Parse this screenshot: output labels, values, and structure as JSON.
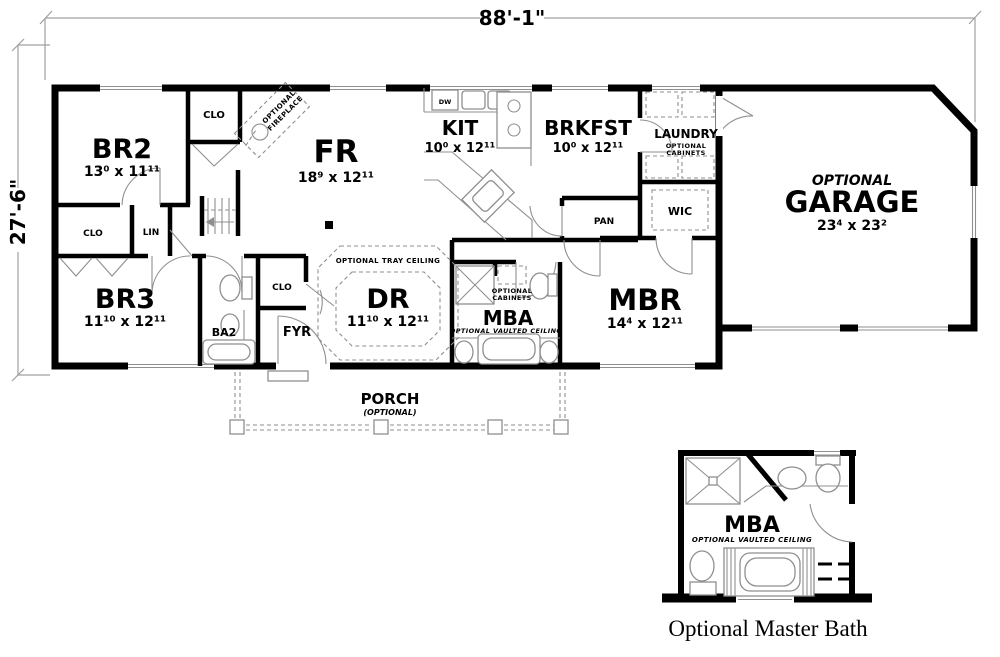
{
  "dimensions": {
    "width_label": "88'-1\"",
    "height_label": "27'-6\""
  },
  "rooms": {
    "br2": {
      "name": "BR2",
      "dims": "13⁰ x 11¹¹"
    },
    "br3": {
      "name": "BR3",
      "dims": "11¹⁰ x 12¹¹"
    },
    "fr": {
      "name": "FR",
      "dims": "18⁹ x 12¹¹"
    },
    "kit": {
      "name": "KIT",
      "dims": "10⁰ x 12¹¹"
    },
    "brkfst": {
      "name": "BRKFST",
      "dims": "10⁰ x 12¹¹"
    },
    "laundry": {
      "name": "LAUNDRY",
      "note_lines": [
        "OPTIONAL",
        "CABINETS"
      ]
    },
    "garage": {
      "prefix": "OPTIONAL",
      "name": "GARAGE",
      "dims": "23⁴ x 23²"
    },
    "dr": {
      "name": "DR",
      "dims": "11¹⁰ x 12¹¹",
      "note": "OPTIONAL TRAY CEILING"
    },
    "mba": {
      "name": "MBA",
      "note": "OPTIONAL VAULTED CEILING",
      "cabinets_lines": [
        "OPTIONAL",
        "CABINETS"
      ]
    },
    "mbr": {
      "name": "MBR",
      "dims": "14⁴ x 12¹¹"
    },
    "ba2": {
      "name": "BA2"
    },
    "fyr": {
      "name": "FYR"
    },
    "wic": {
      "name": "WIC"
    },
    "pan": {
      "name": "PAN"
    },
    "lin": {
      "name": "LIN"
    },
    "clo_br2": {
      "name": "CLO"
    },
    "clo_hall": {
      "name": "CLO"
    },
    "clo_fyr": {
      "name": "CLO"
    },
    "dw": {
      "name": "DW"
    },
    "porch": {
      "name": "PORCH",
      "note": "(OPTIONAL)"
    },
    "fireplace": {
      "note_lines": [
        "OPTIONAL",
        "FIREPLACE"
      ]
    }
  },
  "detail": {
    "name": "MBA",
    "note": "OPTIONAL VAULTED CEILING",
    "caption": "Optional Master Bath"
  },
  "colors": {
    "wall": "#000000",
    "fixture": "#8f8f8f",
    "dim_line": "#a0a0a0"
  }
}
